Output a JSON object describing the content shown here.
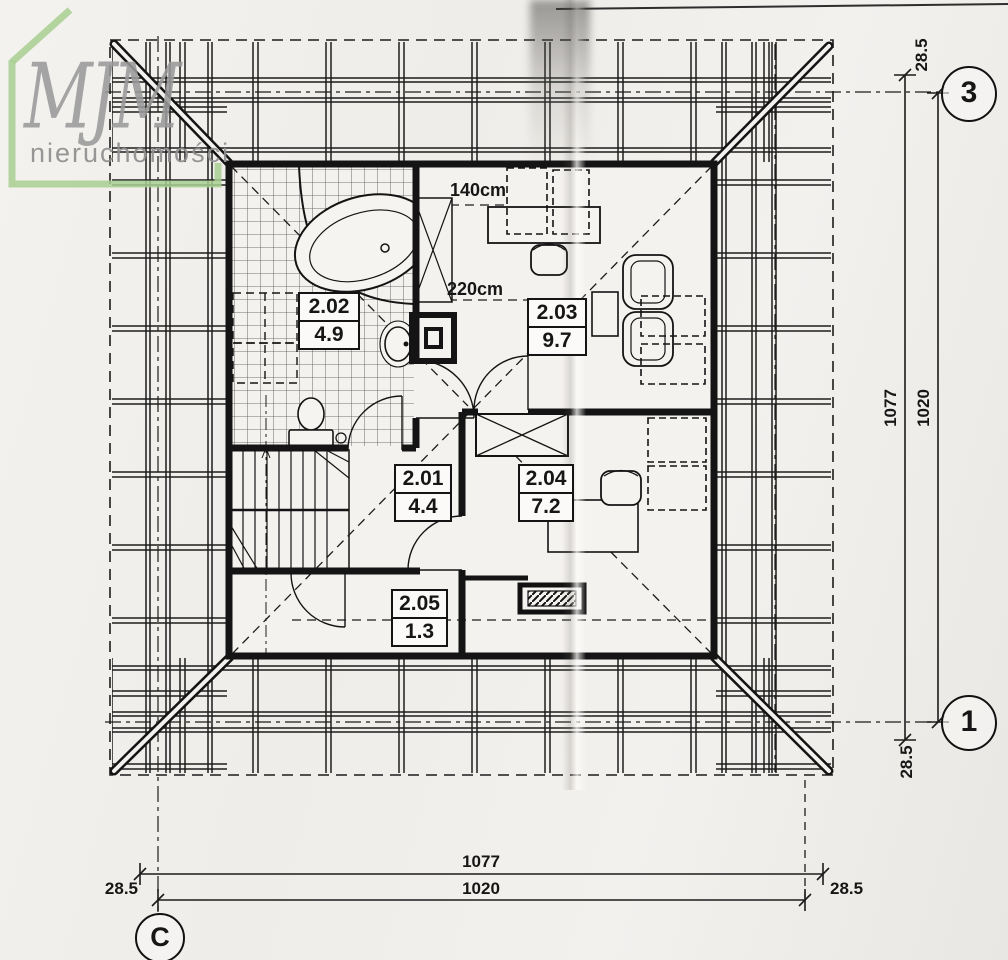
{
  "logo": {
    "brand": "MJM",
    "subtitle": "nieruchomości"
  },
  "rooms": [
    {
      "id": "2.01",
      "area": "4.4"
    },
    {
      "id": "2.02",
      "area": "4.9"
    },
    {
      "id": "2.03",
      "area": "9.7"
    },
    {
      "id": "2.04",
      "area": "7.2"
    },
    {
      "id": "2.05",
      "area": "1.3"
    }
  ],
  "annotations": {
    "skylight_line": "140cm",
    "kneewall_line": "220cm"
  },
  "dim_right": {
    "total": "1077",
    "inner": "1020",
    "offset_top": "28.5",
    "offset_bottom": "28.5"
  },
  "dim_bottom": {
    "total": "1077",
    "inner": "1020",
    "offset_left": "28.5",
    "offset_right": "28.5"
  },
  "axes": {
    "right_top": "3",
    "right_bottom": "1",
    "bottom_left": "C"
  },
  "colors": {
    "logo_green": "#a8cf90",
    "logo_gray": "#9a9a9a",
    "ink": "#1c1c1c",
    "paper": "#f2f0ed"
  }
}
